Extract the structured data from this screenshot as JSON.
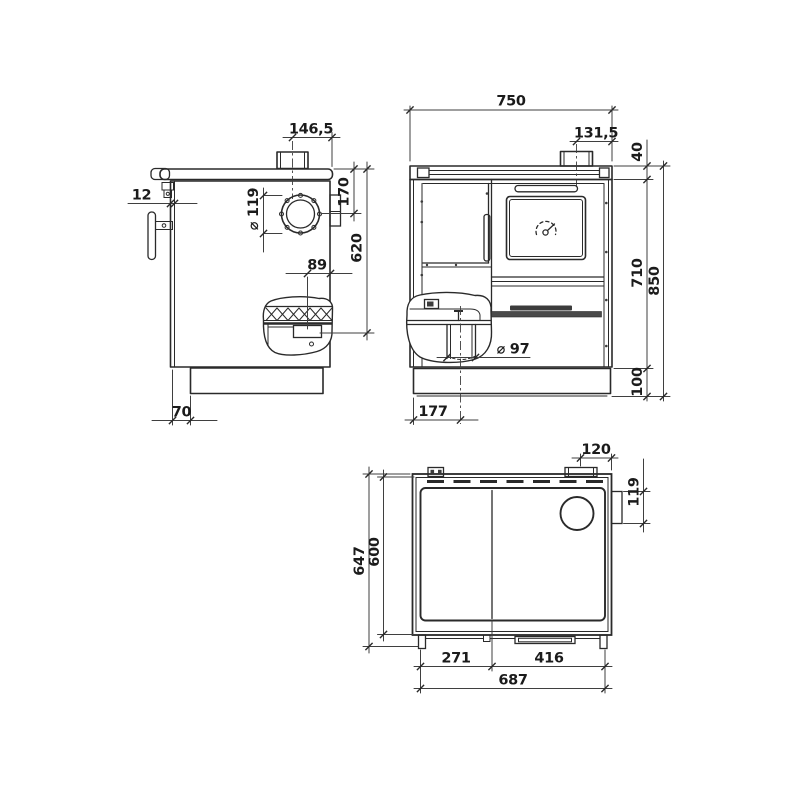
{
  "views": {
    "side": {
      "dims": {
        "flue_center_to_back": "146,5",
        "front_overhang": "12",
        "flue_diameter": "⌀ 119",
        "top_to_flue_center": "170",
        "top_to_rear_outlet": "620",
        "rear_outlet_offset": "89",
        "plinth_recess": "70"
      }
    },
    "front": {
      "dims": {
        "overall_width": "750",
        "flue_center_to_side": "131,5",
        "top_plate_thickness": "40",
        "body_height": "710",
        "overall_height": "850",
        "plinth_height": "100",
        "bottom_outlet_diameter": "⌀ 97",
        "side_to_bottom_outlet": "177"
      }
    },
    "top": {
      "dims": {
        "stub_center_to_side": "120",
        "rear_cover_length": "119",
        "overall_depth": "647",
        "body_depth": "600",
        "hob_left_width": "271",
        "hob_right_width": "416",
        "hob_total_width": "687"
      }
    }
  }
}
